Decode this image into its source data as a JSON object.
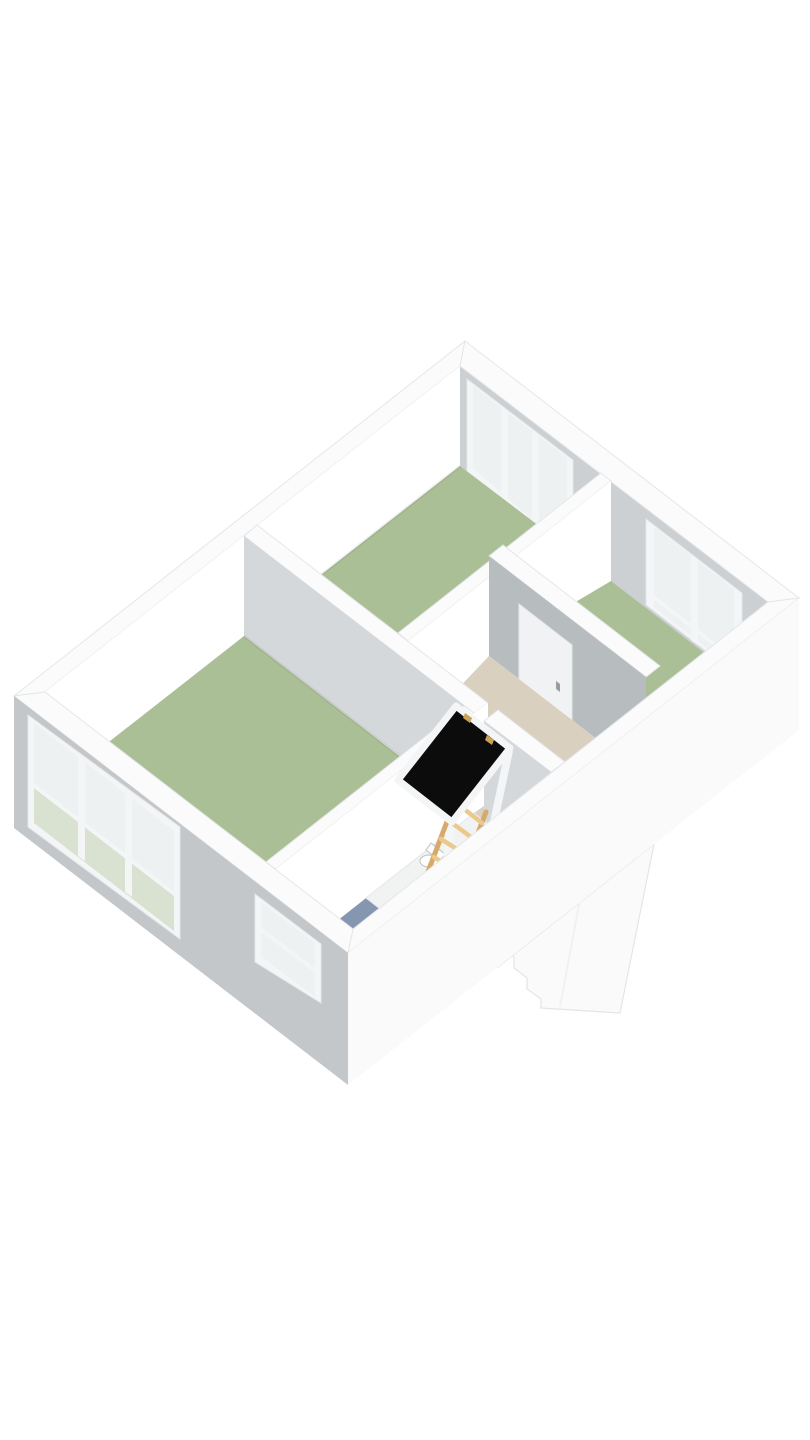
{
  "scene": {
    "kind": "isometric-3d-floorplan-render",
    "background": "#ffffff"
  },
  "palette": {
    "bg": "#ffffff",
    "wall_top": "#fbfbfc",
    "wall_white": "#ffffff",
    "wall_int_ne": "#ccd0d2",
    "wall_ext_sw": "#c4c7ca",
    "wall_ext_se": "#fafafb",
    "wall_gray_light": "#d5d8da",
    "wall_gray_mid": "#b7bcbf",
    "floor_green": "#abbf96",
    "floor_blue": "#8496b0",
    "floor_beige": "#d9d0c0",
    "floor_white": "#f1f2f2",
    "glass": "#eef1f1",
    "glass_green": "#d9e1d1",
    "glass_shower": "#c3cdd6",
    "shower_frame": "#9fabb4",
    "wood": "#d7aa6b",
    "wood_light": "#ebc98c",
    "hatch_black": "#0c0c0c",
    "brass": "#c9a254",
    "frame_white": "#f4f5f6",
    "door_white": "#f1f2f3",
    "handle_gray": "#979da1",
    "edge": "#e4e7e9"
  },
  "rooms": [
    {
      "id": "bedroom-1",
      "position": "lower-left",
      "floor_color": "#abbf96"
    },
    {
      "id": "bedroom-2",
      "position": "top-center",
      "floor_color": "#abbf96"
    },
    {
      "id": "bedroom-3",
      "position": "right",
      "floor_color": "#abbf96"
    },
    {
      "id": "landing-stairwell",
      "position": "center",
      "floor_color": "#d9d0c0"
    },
    {
      "id": "bathroom",
      "position": "bottom-center",
      "floor_color": "#8496b0"
    }
  ],
  "windows": [
    {
      "id": "window-sw-large",
      "wall": "southwest",
      "panes": 3
    },
    {
      "id": "window-sw-small",
      "wall": "southwest",
      "panes": 2
    },
    {
      "id": "window-ne-top",
      "wall": "northeast",
      "panes": 3
    },
    {
      "id": "window-ne-right",
      "wall": "northeast",
      "panes": 2
    }
  ],
  "doors": [
    {
      "id": "door-landing-to-bedroom-3",
      "state": "closed",
      "color": "#f1f2f3"
    },
    {
      "id": "door-bathroom",
      "state": "closed",
      "color": "#ffffff"
    }
  ],
  "objects": [
    {
      "id": "attic-hatch",
      "color": "#0c0c0c",
      "hinges": "#c9a254",
      "frame": "#f4f5f6"
    },
    {
      "id": "loft-ladder",
      "material_color": "#d7aa6b"
    },
    {
      "id": "shower-enclosure",
      "glass_color": "#c3cdd6",
      "tray_color": "#f1f2f2"
    },
    {
      "id": "toilet",
      "color": "#ffffff"
    },
    {
      "id": "stair-bulkhead",
      "color": "#fafafb"
    }
  ]
}
